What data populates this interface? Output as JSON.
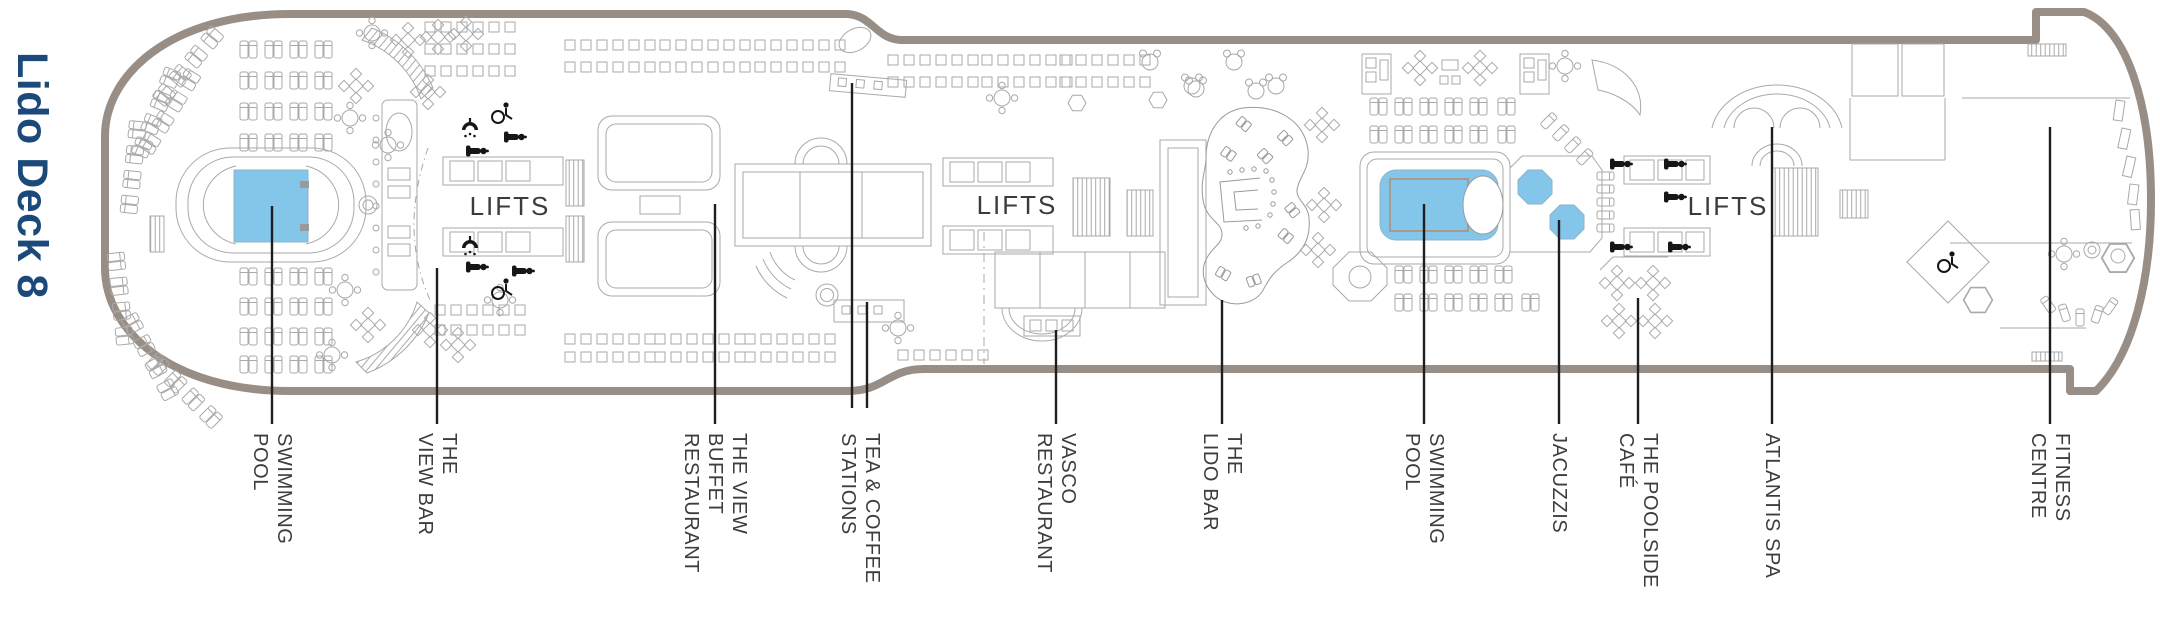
{
  "title": "Lido Deck 8",
  "plan": {
    "lifts_label": "LIFTS",
    "labels": [
      {
        "id": "swimming-pool-forward",
        "lines": [
          "SWIMMING",
          "POOL"
        ]
      },
      {
        "id": "the-view-bar",
        "lines": [
          "THE",
          "VIEW BAR"
        ]
      },
      {
        "id": "the-view-buffet-restaurant",
        "lines": [
          "THE VIEW",
          "BUFFET",
          "RESTAURANT"
        ]
      },
      {
        "id": "tea-and-coffee-stations",
        "lines": [
          "TEA & COFFEE",
          "STATIONS"
        ]
      },
      {
        "id": "vasco-restaurant",
        "lines": [
          "VASCO",
          "RESTAURANT"
        ]
      },
      {
        "id": "the-lido-bar",
        "lines": [
          "THE",
          "LIDO BAR"
        ]
      },
      {
        "id": "swimming-pool-aft",
        "lines": [
          "SWIMMING",
          "POOL"
        ]
      },
      {
        "id": "jacuzzis",
        "lines": [
          "JACUZZIS"
        ]
      },
      {
        "id": "the-poolside-cafe",
        "lines": [
          "THE POOLSIDE",
          "CAFÉ"
        ]
      },
      {
        "id": "atlantis-spa",
        "lines": [
          "ATLANTIS SPA"
        ]
      },
      {
        "id": "fitness-centre",
        "lines": [
          "FITNESS",
          "CENTRE"
        ]
      }
    ],
    "colors": {
      "pool_water": "#83c6ea",
      "hull_outline": "#988e85",
      "deck_linework": "#a9a9a9",
      "title_text": "#1b4a7a",
      "label_text": "#3d3d3d",
      "leader_line": "#1e1e1e"
    }
  }
}
